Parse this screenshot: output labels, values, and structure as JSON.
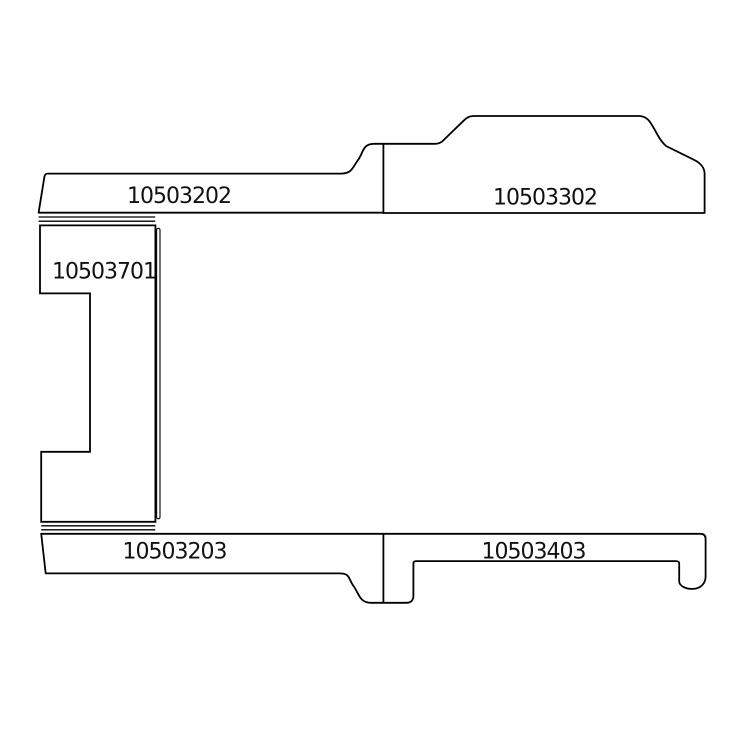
{
  "diagram": {
    "type": "technical-line-drawing",
    "background_color": "#ffffff",
    "line_color": "#000000",
    "parts": [
      {
        "id": "top-left-strip",
        "label": "10503202"
      },
      {
        "id": "top-right-strip",
        "label": "10503302"
      },
      {
        "id": "left-panel",
        "label": "10503701"
      },
      {
        "id": "bottom-left-strip",
        "label": "10503203"
      },
      {
        "id": "bottom-right-strip",
        "label": "10503403"
      }
    ]
  }
}
